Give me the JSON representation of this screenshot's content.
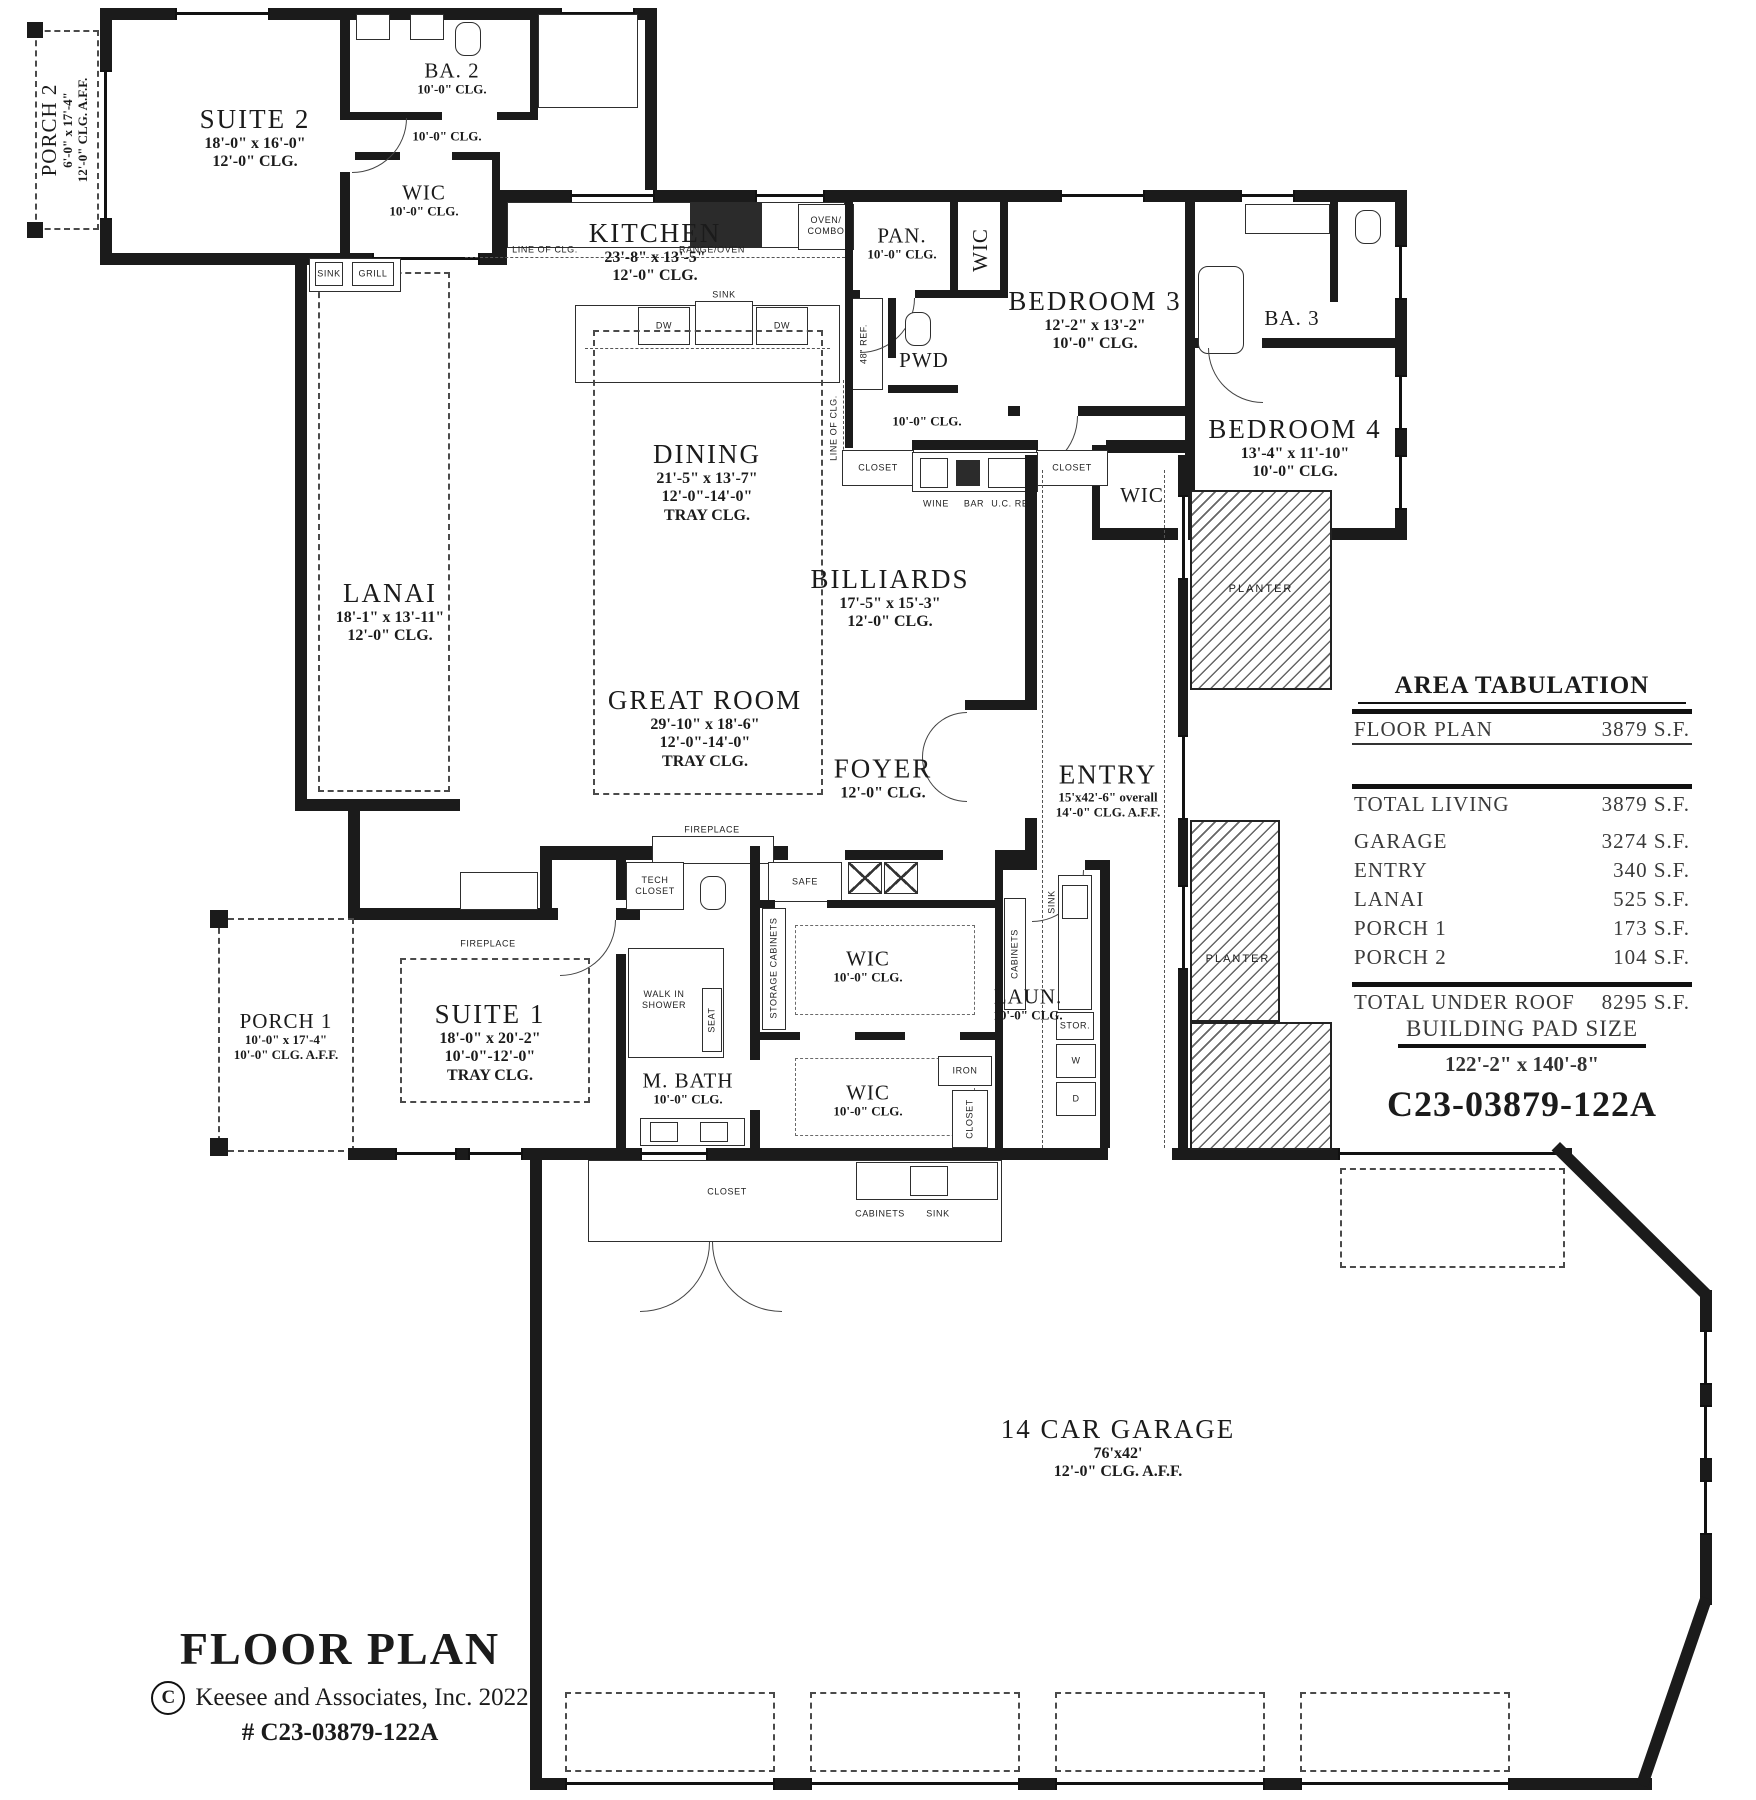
{
  "meta": {
    "sheet_title": "FLOOR PLAN",
    "copyright_symbol": "C",
    "copyright": "Keesee and Associates, Inc. 2022",
    "plan_number": "# C23-03879-122A"
  },
  "area_tabulation": {
    "title": "AREA TABULATION",
    "rows": [
      {
        "label": "FLOOR PLAN",
        "value": "3879 S.F."
      },
      {
        "label": "TOTAL LIVING",
        "value": "3879 S.F."
      },
      {
        "label": "GARAGE",
        "value": "3274 S.F."
      },
      {
        "label": "ENTRY",
        "value": "340 S.F."
      },
      {
        "label": "LANAI",
        "value": "525 S.F."
      },
      {
        "label": "PORCH 1",
        "value": "173 S.F."
      },
      {
        "label": "PORCH 2",
        "value": "104 S.F."
      },
      {
        "label": "TOTAL UNDER ROOF",
        "value": "8295 S.F."
      }
    ],
    "building_pad_title": "BUILDING PAD SIZE",
    "building_pad_size": "122'-2\" x 140'-8\"",
    "plan_code": "C23-03879-122A"
  },
  "rooms": {
    "porch2": {
      "name": "PORCH 2",
      "dim": "6'-0\" x 17'-4\"",
      "clg": "12'-0\" CLG. A.F.F."
    },
    "suite2": {
      "name": "SUITE 2",
      "dim": "18'-0\" x 16'-0\"",
      "clg": "12'-0\" CLG."
    },
    "ba2": {
      "name": "BA. 2",
      "clg": "10'-0\" CLG."
    },
    "hall2": {
      "clg": "10'-0\" CLG."
    },
    "wic_s2": {
      "name": "WIC",
      "clg": "10'-0\" CLG."
    },
    "kitchen": {
      "name": "KITCHEN",
      "dim": "23'-8\" x 13'-5\"",
      "clg": "12'-0\" CLG."
    },
    "pantry": {
      "name": "PAN.",
      "clg": "10'-0\" CLG."
    },
    "pwd": {
      "name": "PWD"
    },
    "bedroom3": {
      "name": "BEDROOM 3",
      "dim": "12'-2\" x 13'-2\"",
      "clg": "10'-0\" CLG."
    },
    "ba3": {
      "name": "BA. 3"
    },
    "bedroom4": {
      "name": "BEDROOM 4",
      "dim": "13'-4\" x 11'-10\"",
      "clg": "10'-0\" CLG."
    },
    "wic_b3": {
      "name": "WIC"
    },
    "wic_b4": {
      "name": "WIC"
    },
    "hall_bed": {
      "clg": "10'-0\" CLG."
    },
    "lanai": {
      "name": "LANAI",
      "dim": "18'-1\" x 13'-11\"",
      "clg": "12'-0\" CLG."
    },
    "dining": {
      "name": "DINING",
      "dim": "21'-5\" x 13'-7\"",
      "clg1": "12'-0\"-14'-0\"",
      "clg2": "TRAY CLG."
    },
    "great": {
      "name": "GREAT ROOM",
      "dim": "29'-10\" x 18'-6\"",
      "clg1": "12'-0\"-14'-0\"",
      "clg2": "TRAY CLG."
    },
    "billiards": {
      "name": "BILLIARDS",
      "dim": "17'-5\" x 15'-3\"",
      "clg": "12'-0\" CLG."
    },
    "foyer": {
      "name": "FOYER",
      "clg": "12'-0\" CLG."
    },
    "entry": {
      "name": "ENTRY",
      "dim": "15'x42'-6\" overall",
      "clg": "14'-0\" CLG. A.F.F."
    },
    "porch1": {
      "name": "PORCH 1",
      "dim": "10'-0\" x 17'-4\"",
      "clg": "10'-0\" CLG. A.F.F."
    },
    "suite1": {
      "name": "SUITE 1",
      "dim": "18'-0\" x 20'-2\"",
      "clg1": "10'-0\"-12'-0\"",
      "clg2": "TRAY CLG."
    },
    "mbath": {
      "name": "M. BATH",
      "clg": "10'-0\" CLG."
    },
    "wic_m1": {
      "name": "WIC",
      "clg": "10'-0\" CLG."
    },
    "wic_m2": {
      "name": "WIC",
      "clg": "10'-0\" CLG."
    },
    "laundry": {
      "name": "LAUN.",
      "clg": "10'-0\" CLG."
    },
    "garage": {
      "name": "14 CAR GARAGE",
      "dim": "76'x42'",
      "clg": "12'-0\" CLG. A.F.F."
    }
  },
  "labels": {
    "sink": "SINK",
    "grill": "GRILL",
    "line_of_clg": "LINE OF CLG.",
    "range_oven": "RANGE/OVEN",
    "oven_combo_1": "OVEN/",
    "oven_combo_2": "COMBO",
    "dw": "DW",
    "ref48": "48\" REF.",
    "wine": "WINE",
    "bar": "BAR",
    "uc_ref": "U.C. REF.",
    "closet": "CLOSET",
    "tech_closet_1": "TECH",
    "tech_closet_2": "CLOSET",
    "safe": "SAFE",
    "storage_cabinets": "STORAGE CABINETS",
    "walk_in_1": "WALK IN",
    "walk_in_2": "SHOWER",
    "seat": "SEAT",
    "iron": "IRON",
    "cabinets": "CABINETS",
    "stor": "STOR.",
    "washer": "W",
    "dryer": "D",
    "fireplace": "FIREPLACE",
    "planter": "PLANTER"
  }
}
